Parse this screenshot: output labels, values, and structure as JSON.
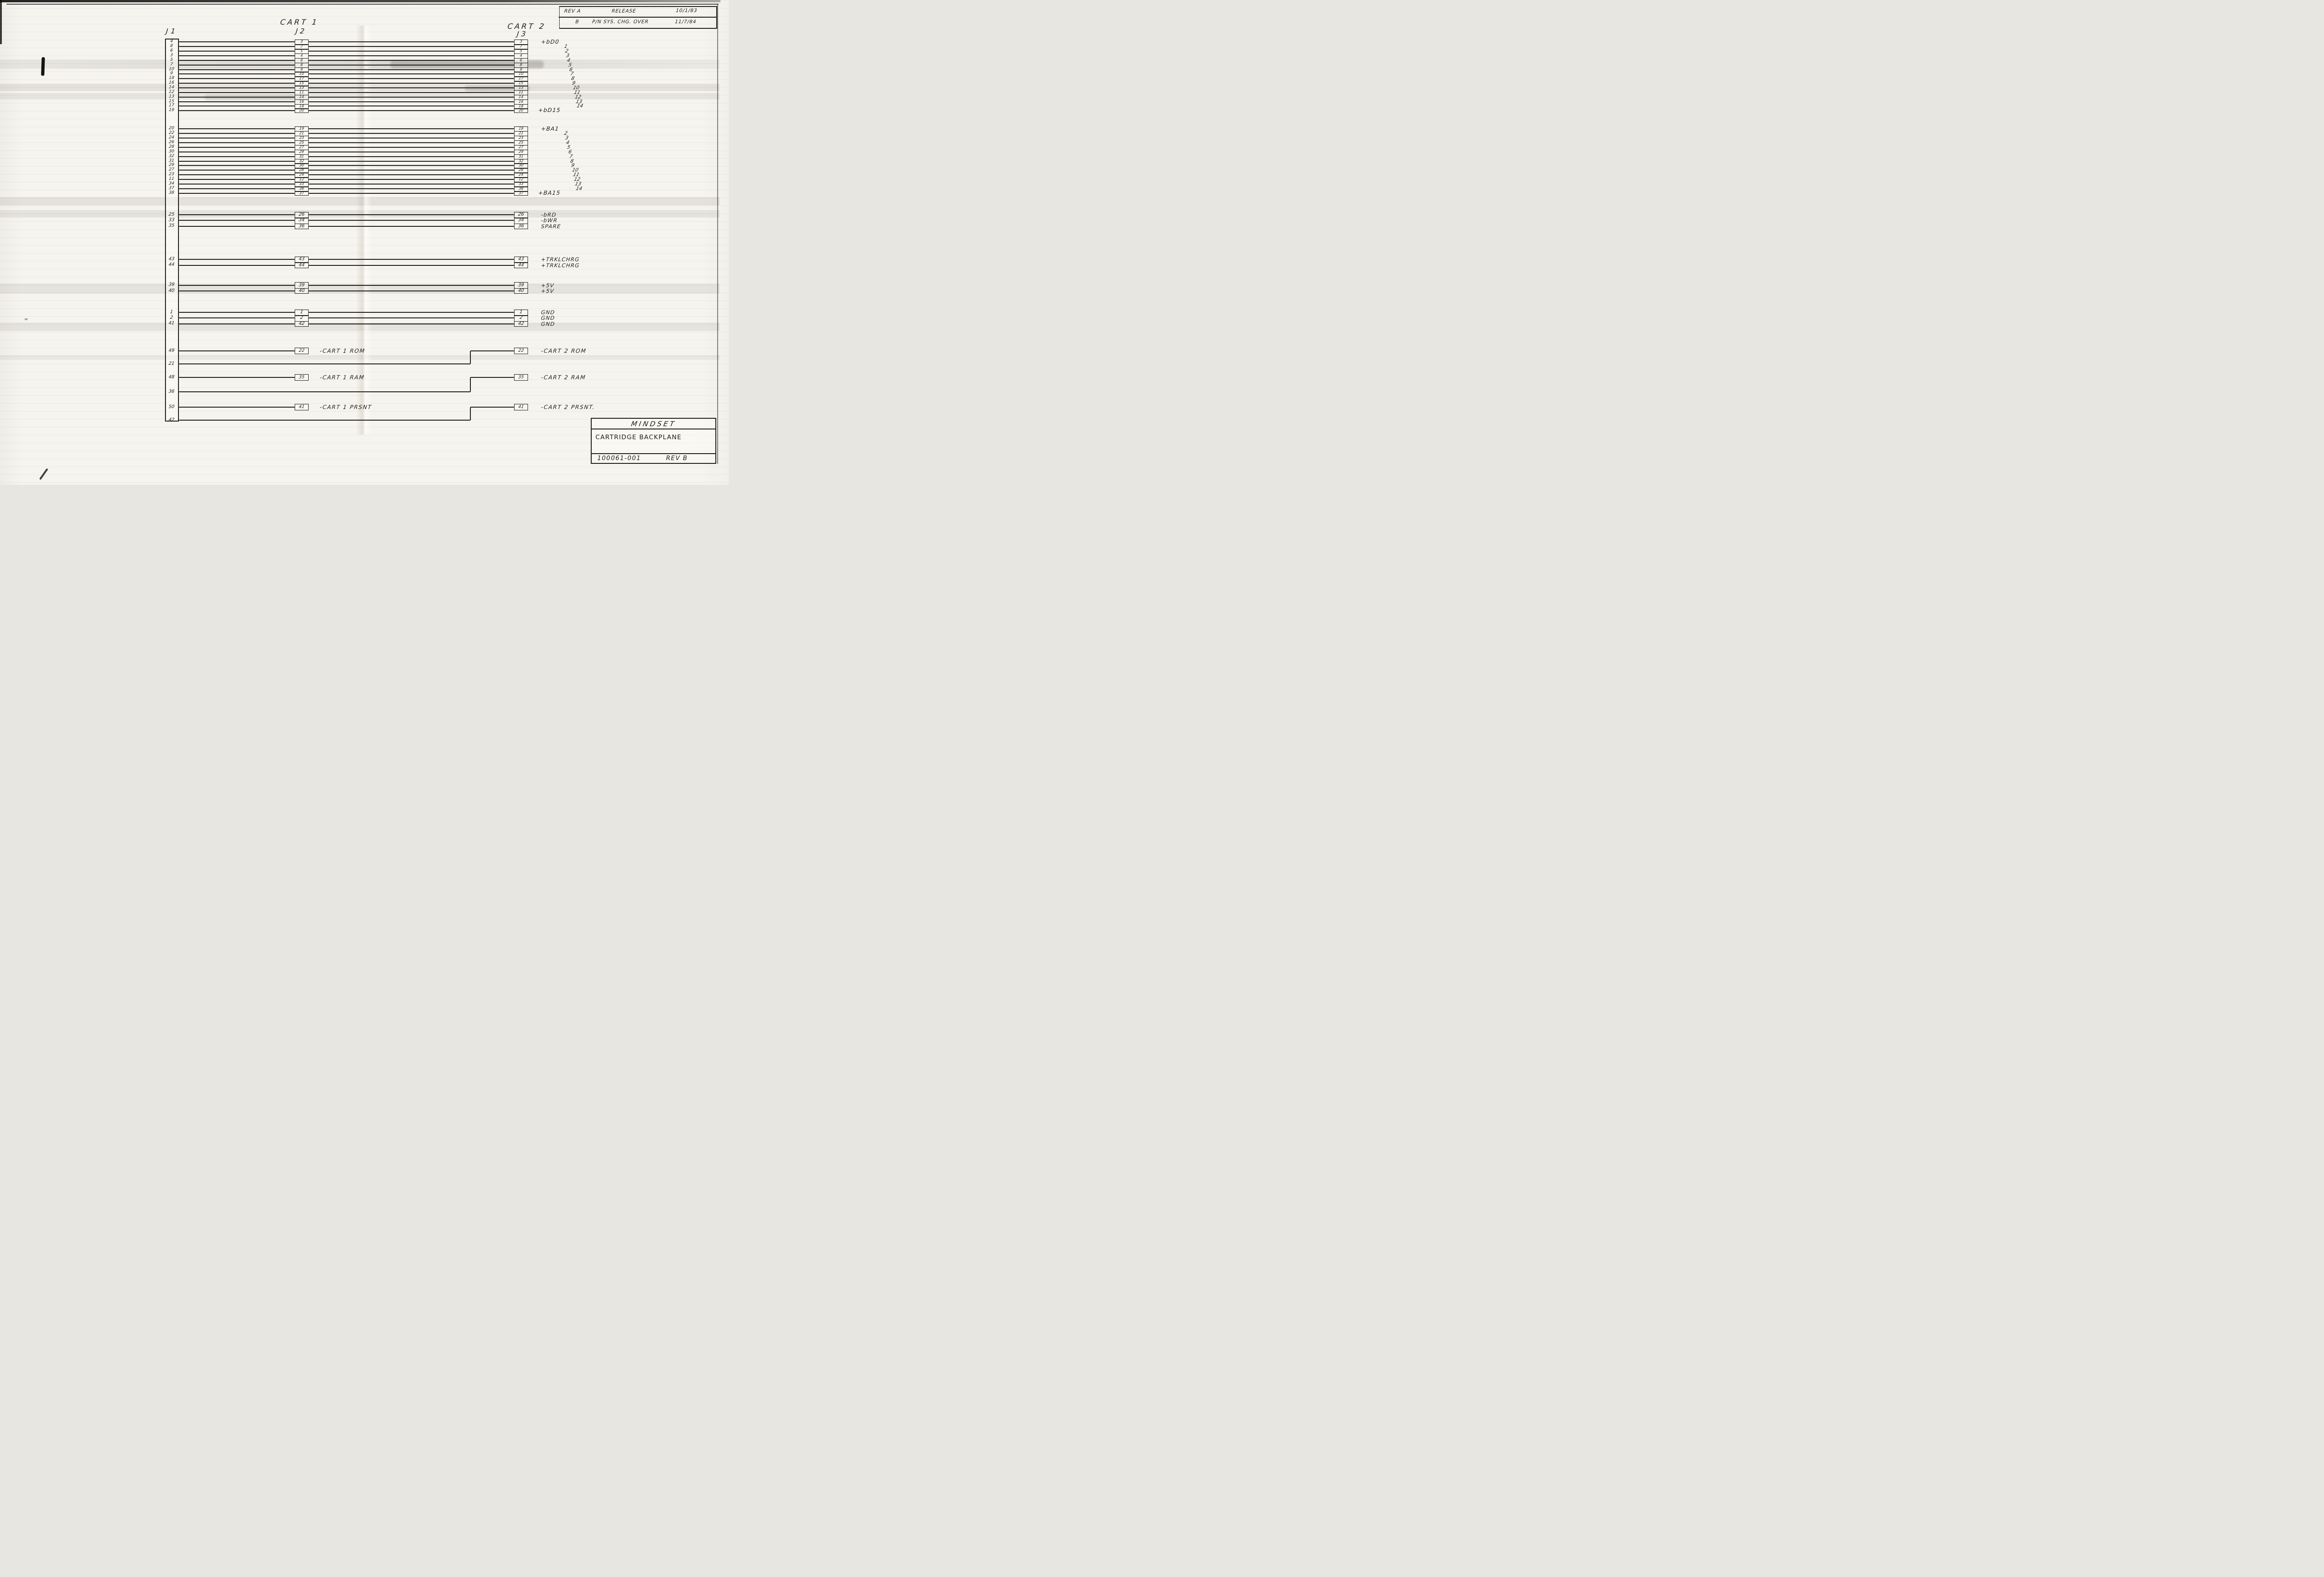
{
  "page": {
    "headers": {
      "j1": "J1",
      "j2": "J2",
      "j3": "J3",
      "cart1": "CART 1",
      "cart2": "CART 2"
    }
  },
  "revision_table": {
    "rows": [
      {
        "rev": "REV A",
        "description": "RELEASE",
        "date": "10/1/83"
      },
      {
        "rev": "B",
        "description": "P/N SYS. CHG. OVER",
        "date": "11/7/84"
      }
    ]
  },
  "title_block": {
    "company": "MINDSET",
    "drawing_title": "CARTRIDGE BACKPLANE",
    "part_number": "100061-001",
    "revision": "REV B"
  },
  "buses": [
    {
      "name": "data-bus",
      "j1": [
        "4",
        "8",
        "6",
        "3",
        "5",
        "7",
        "10",
        "9",
        "18",
        "16",
        "14",
        "12",
        "13",
        "15",
        "17",
        "19"
      ],
      "j2": [
        "3",
        "7",
        "5",
        "4",
        "6",
        "8",
        "9",
        "10",
        "17",
        "15",
        "13",
        "11",
        "14",
        "16",
        "18",
        "20"
      ],
      "j3": [
        "3",
        "7",
        "5",
        "4",
        "6",
        "8",
        "9",
        "10",
        "17",
        "15",
        "13",
        "11",
        "14",
        "16",
        "18",
        "20"
      ],
      "labels": [
        "+bD0",
        "1",
        "2",
        "3",
        "4",
        "5",
        "6",
        "7",
        "8",
        "9",
        "10",
        "11",
        "12",
        "13",
        "14",
        "+bD15"
      ],
      "label_style": "bus"
    },
    {
      "name": "address-bus",
      "j1": [
        "20",
        "22",
        "24",
        "26",
        "28",
        "30",
        "32",
        "31",
        "29",
        "27",
        "23",
        "11",
        "34",
        "37",
        "38"
      ],
      "j2": [
        "19",
        "21",
        "23",
        "25",
        "27",
        "29",
        "31",
        "32",
        "30",
        "28",
        "24",
        "12",
        "33",
        "38",
        "37"
      ],
      "j3": [
        "19",
        "21",
        "23",
        "25",
        "27",
        "29",
        "31",
        "32",
        "30",
        "28",
        "24",
        "12",
        "33",
        "38",
        "37"
      ],
      "labels": [
        "+BA1",
        "2",
        "3",
        "4",
        "5",
        "6",
        "7",
        "8",
        "9",
        "10",
        "11",
        "12",
        "13",
        "14",
        "+BA15"
      ],
      "label_style": "bus"
    },
    {
      "name": "control",
      "j1": [
        "25",
        "33",
        "35"
      ],
      "j2": [
        "26",
        "34",
        "36"
      ],
      "j3": [
        "26",
        "34",
        "36"
      ],
      "labels": [
        "-bRD",
        "-bWR",
        "SPARE"
      ],
      "label_style": "plain"
    },
    {
      "name": "trickle-charge",
      "j1": [
        "43",
        "44"
      ],
      "j2": [
        "43",
        "44"
      ],
      "j3": [
        "43",
        "44"
      ],
      "labels": [
        "+TRKLCHRG",
        "+TRKLCHRG"
      ],
      "label_style": "plain"
    },
    {
      "name": "power",
      "j1": [
        "39",
        "40"
      ],
      "j2": [
        "39",
        "40"
      ],
      "j3": [
        "39",
        "40"
      ],
      "labels": [
        "+5V",
        "+5V"
      ],
      "label_style": "plain"
    },
    {
      "name": "ground",
      "j1": [
        "1",
        "2",
        "41"
      ],
      "j2": [
        "1",
        "2",
        "42"
      ],
      "j3": [
        "1",
        "2",
        "42"
      ],
      "labels": [
        "GND",
        "GND",
        "GND"
      ],
      "label_style": "plain"
    }
  ],
  "cart_section": {
    "rows": [
      {
        "j1_pin": "49",
        "j2_pin": "22",
        "j2_label": "-CART 1 ROM"
      },
      {
        "j1_pin": "21",
        "j3_pin": "22",
        "j3_label": "-CART 2 ROM"
      },
      {
        "j1_pin": "48",
        "j2_pin": "35",
        "j2_label": "-CART 1 RAM"
      },
      {
        "j1_pin": "36",
        "j3_pin": "35",
        "j3_label": "-CART 2 RAM"
      },
      {
        "j1_pin": "50",
        "j2_pin": "41",
        "j2_label": "-CART 1 PRSNT"
      },
      {
        "j1_pin": "42",
        "j3_pin": "41",
        "j3_label": "-CART 2 PRSNT."
      }
    ]
  }
}
